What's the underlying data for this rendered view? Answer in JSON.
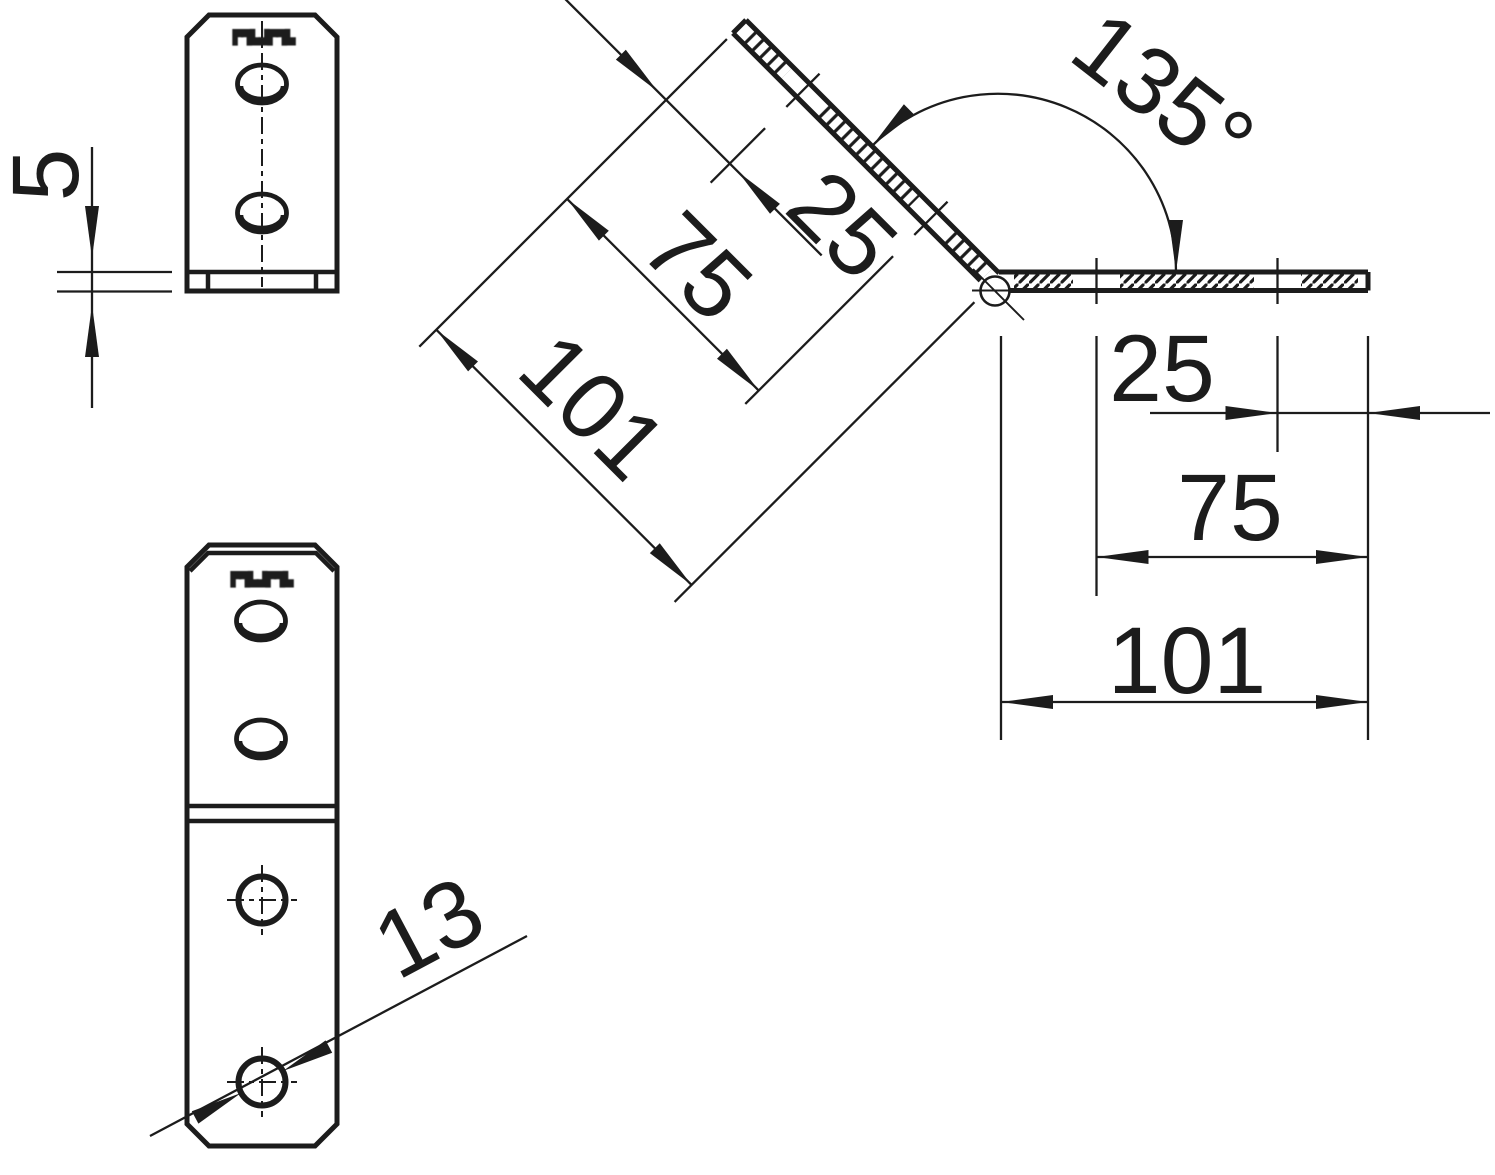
{
  "colors": {
    "ink": "#1c1c1c",
    "background": "#ffffff"
  },
  "stamp_marking": "▛▜▙▟▛▜▙",
  "dimensions": {
    "plate_thickness": "5",
    "hole_diameter": "13",
    "bend_angle": "135°",
    "upper_leg": {
      "hole1_offset": "25",
      "hole2_offset": "75",
      "length": "101"
    },
    "lower_leg": {
      "hole1_offset": "25",
      "hole2_offset": "75",
      "length": "101"
    }
  }
}
